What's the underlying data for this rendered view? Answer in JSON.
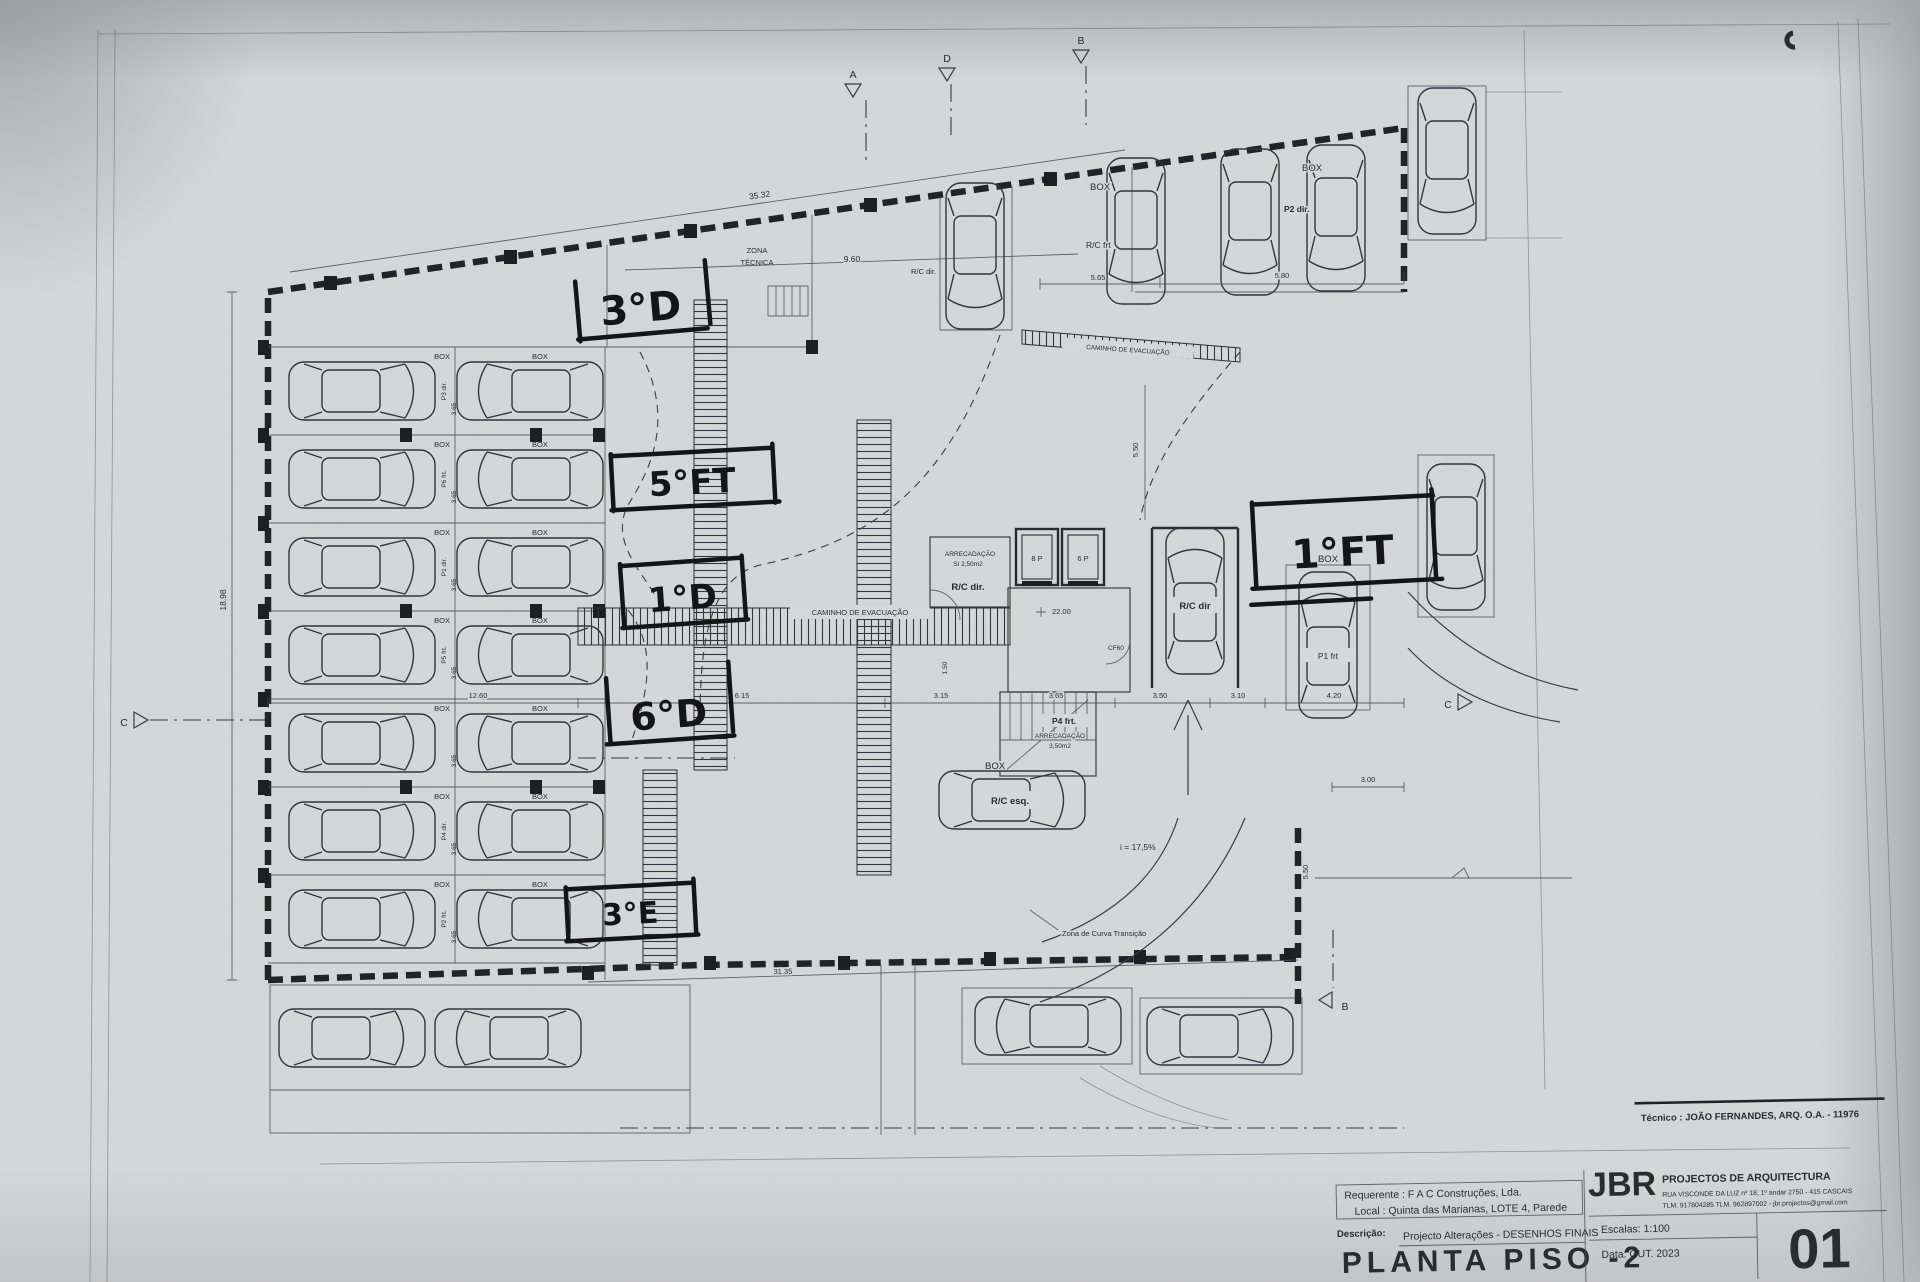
{
  "sheet": {
    "tecnico_line": "Técnico : JOÃO FERNANDES, ARQ.   O.A. - 11976",
    "requerente": "Requerente : F A C  Construções, Lda.",
    "local": "Local : Quinta das Marianas, LOTE 4, Parede",
    "descricao_label": "Descrição:",
    "descricao": "Projecto Alterações - DESENHOS FINAIS",
    "title": "PLANTA PISO -2",
    "firm_initials": "JBR",
    "firm_name": "PROJECTOS DE ARQUITECTURA",
    "firm_address": "RUA VISCONDE DA LUZ nº 18, 1º andar  2750 - 415 CASCAIS",
    "firm_contacts": "TLM. 917804285  TLM. 962897002 - jbr.projectos@gmail.com",
    "escalas": "Escalas:  1:100",
    "data": "Data: OUT.  2023",
    "sheet_number": "01"
  },
  "handwritten": {
    "n1": "3°D",
    "n2": "5°FT",
    "n3": "1°D",
    "n4": "6°D",
    "n5": "3°E",
    "n6": "1°FT"
  },
  "labels": {
    "zona_tecnica_1": "ZONA",
    "zona_tecnica_2": "TÉCNICA",
    "caminho_evacuacao": "CAMINHO  DE  EVACUAÇÃO",
    "caminho_evacuacao_2": "CAMINHO  DE  EVACUAÇÃO",
    "arrecadacao_1a": "ARRECADAÇÃO",
    "arrecadacao_1b": "SI 2,50m2",
    "arrecadacao_1c": "R/C dir.",
    "stairs_spot": "P4 frt.",
    "arrecadacao_2b": "ARRECADAÇÃO",
    "arrecadacao_2c": "3,50m2",
    "elev_1": "8 P",
    "elev_2": "6 P",
    "level": "22.00",
    "cf": "CF60",
    "slope": "i = 17,5%",
    "curva": "Zona de Curva Transição",
    "box_center": "BOX",
    "rc_esq": "R/C esq.",
    "rc_dir_box": "R/C dir",
    "rc_dir_top": "R/C dir.",
    "rc_frt": "R/C frt",
    "box_top_left": "BOX",
    "box_top_right": "BOX",
    "box_right": "BOX",
    "p1_frt": "P1 frt",
    "p2_dir": "P2 dir."
  },
  "parking_rows": [
    {
      "box_l": "BOX",
      "box_r": "BOX",
      "spot": "P3 dir.",
      "dim": "3.65"
    },
    {
      "box_l": "BOX",
      "box_r": "BOX",
      "spot": "P6 frt.",
      "dim": "3.65"
    },
    {
      "box_l": "BOX",
      "box_r": "BOX",
      "spot": "P1 dir.",
      "dim": "3.65"
    },
    {
      "box_l": "BOX",
      "box_r": "BOX",
      "spot": "P5 frt.",
      "dim": "3.65"
    },
    {
      "box_l": "BOX",
      "box_r": "BOX",
      "spot": "",
      "dim": "3.65"
    },
    {
      "box_l": "BOX",
      "box_r": "BOX",
      "spot": "P4 dir.",
      "dim": "3.65"
    },
    {
      "box_l": "BOX",
      "box_r": "BOX",
      "spot": "P2 frt.",
      "dim": "3.65"
    }
  ],
  "dims": {
    "top_len": "35.32",
    "top_w": "9.60",
    "tr_1": "5.65",
    "tr_2": "5.80",
    "left_h": "18.98",
    "left_w": "12.60",
    "m1": "6.15",
    "m2": "3.15",
    "m3": "3.65",
    "m4": "3.50",
    "m5": "3.10",
    "m6": "4.20",
    "v_top": "5.50",
    "v_bottom": "5.50",
    "v_core": "1.50",
    "bottom_len": "31.35",
    "right_w": "3.00"
  },
  "markers": {
    "a": "A",
    "d": "D",
    "b": "B",
    "c_left": "C",
    "c_right": "C",
    "b_bottom": "B"
  }
}
